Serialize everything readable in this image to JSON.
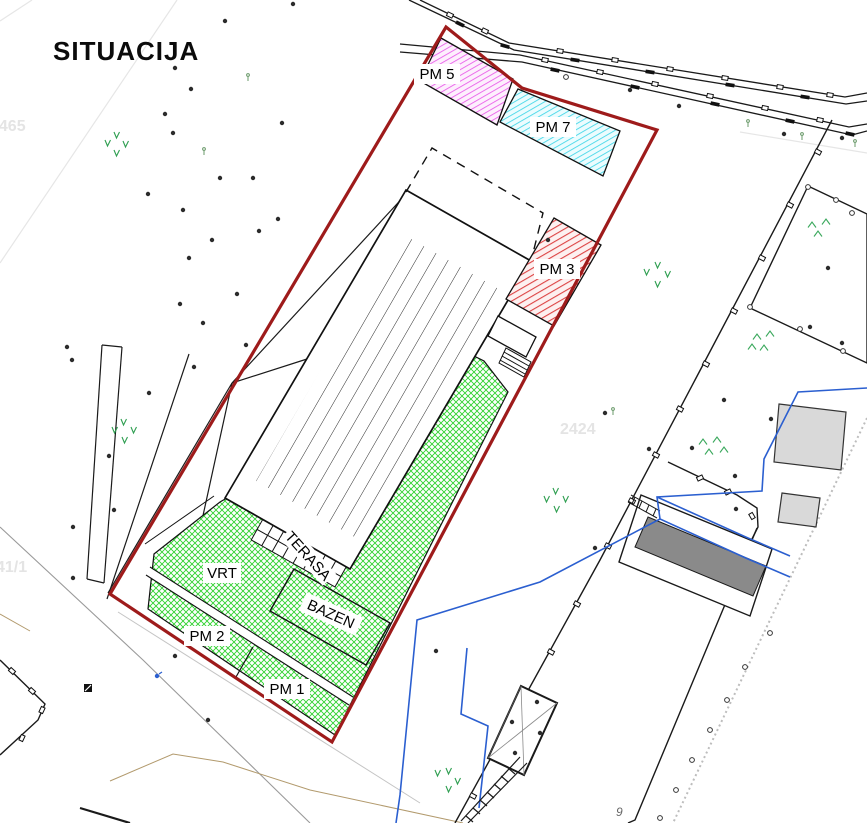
{
  "title": "SITUACIJA",
  "labels": {
    "pm5": "PM 5",
    "pm7": "PM 7",
    "pm3": "PM 3",
    "pm2": "PM 2",
    "pm1": "PM 1",
    "vrt": "VRT",
    "terasa": "TERASA",
    "bazen": "BAZEN"
  },
  "parcel_numbers": {
    "left": "2465",
    "middle": "2424",
    "bottom_left": "41/1",
    "bottom_right": "9"
  },
  "colors": {
    "boundary_red": "#9e1b1b",
    "stall_magenta": "#e959e9",
    "stall_cyan": "#3fd6e8",
    "stall_red": "#dd4444",
    "green_hatch": "#2fd12f",
    "water_blue": "#2b5fd0",
    "building_gray": "#8a8a8a",
    "light_gray_fill": "#d9d9d9"
  }
}
